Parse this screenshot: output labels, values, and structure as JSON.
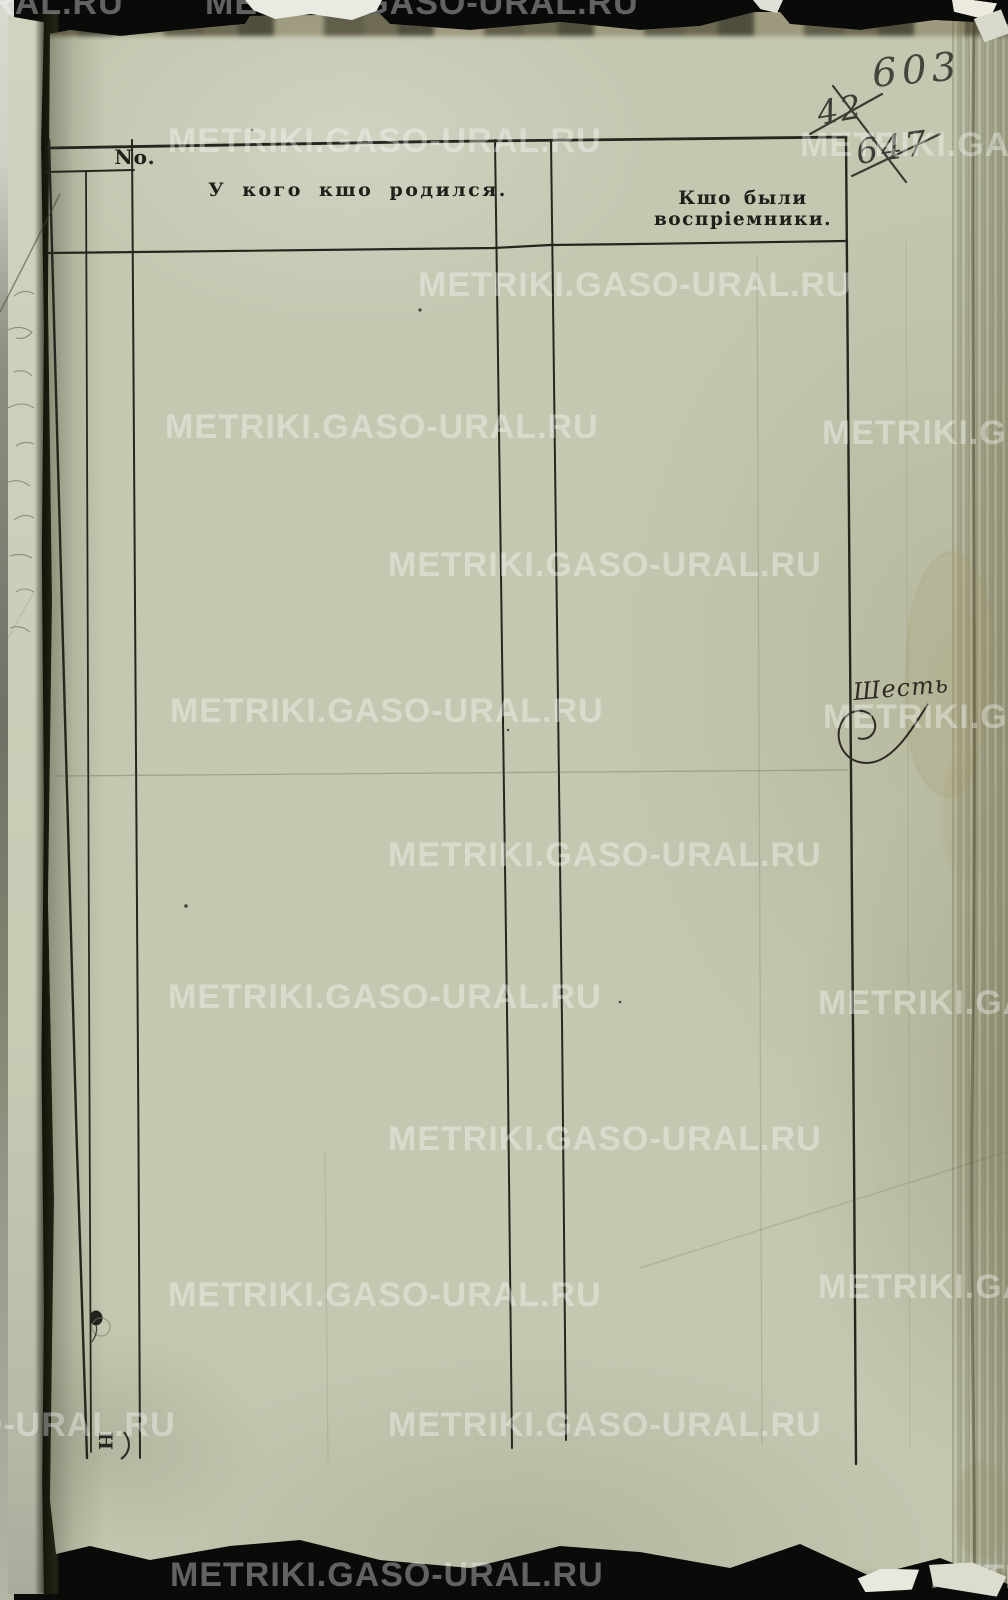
{
  "document": {
    "kind": "scanned metric book page, blank ruled form",
    "handwritten_page_number": "603",
    "crossed_out_numbers": [
      "42",
      "647"
    ],
    "margin_annotation": "Шесть",
    "custos_letter": "Н"
  },
  "table": {
    "headers": {
      "no": "No.",
      "male": "Мужеска пола.",
      "female": "Женска пола.",
      "born": "У кого кшо родился.",
      "baptism_date": "Числа крещенія.",
      "godparents": "Кшо были воспріемники."
    }
  },
  "watermark": {
    "text": "METRIKI.GASO-URAL.RU",
    "color": "#ffffff",
    "opacity": 0.36
  },
  "colors": {
    "paper": "#c3c8b1",
    "ink_lines": "#26261f",
    "handwriting_ink": "#3c3c34",
    "background": "#0a0a08"
  }
}
